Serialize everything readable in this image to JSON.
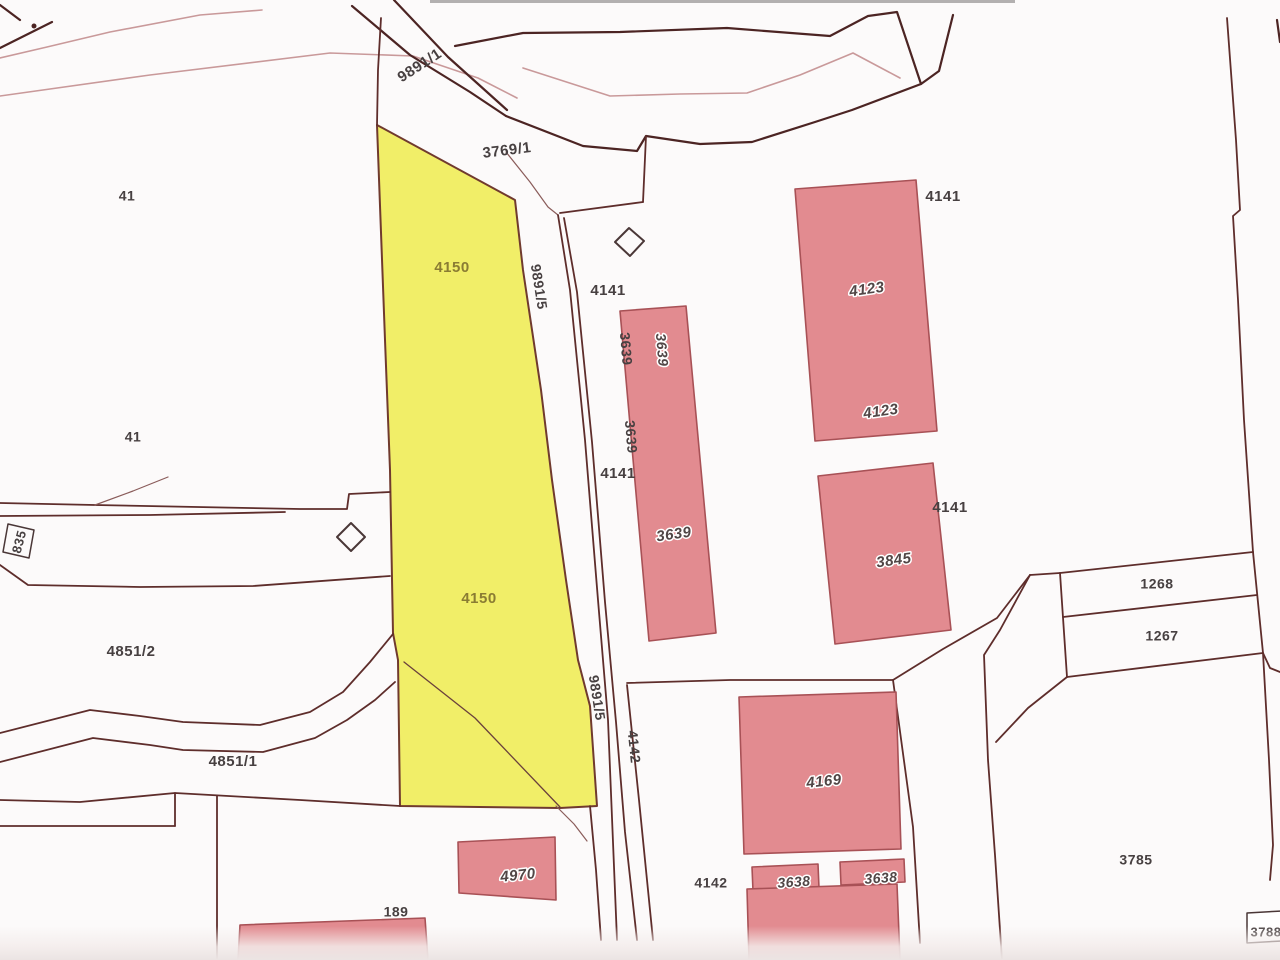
{
  "map": {
    "width": 1280,
    "height": 960,
    "background": "#fcfafa",
    "colors": {
      "highlight_parcel_fill": "#f1ee68",
      "highlight_parcel_stroke": "#703a2e",
      "building_fill": "#e28b90",
      "building_stroke": "#a85156",
      "boundary_dark": "#5e2d2b",
      "boundary_heavy": "#4c2423",
      "boundary_light": "#c9999a",
      "boundary_thin": "#8a5c5a",
      "marker_stroke": "#4a3737",
      "label_dark": "#474041",
      "label_olive": "#8a7c33"
    },
    "styles": {
      "ln": {
        "stroke": "#5e2d2b",
        "w": 1.8
      },
      "ln2": {
        "stroke": "#6a403c",
        "w": 1.3
      },
      "hv": {
        "stroke": "#4c2423",
        "w": 2.2
      },
      "lt": {
        "stroke": "#c9999a",
        "w": 1.6
      },
      "thin": {
        "stroke": "#8a5c5a",
        "w": 1.2
      },
      "mk": {
        "stroke": "#4a3737",
        "w": 2.0
      }
    },
    "polygons": [
      {
        "name": "parcel-4150-highlight",
        "fill": "#f1ee68",
        "stroke": "#703a2e",
        "w": 2,
        "pts": "377,125 515,200 523,270 541,390 552,480 566,580 578,660 590,706 597,806 560,808 400,806 398,660 393,633 390,470 385,340"
      },
      {
        "name": "building-4123",
        "fill": "#e28b90",
        "stroke": "#a85156",
        "w": 1.6,
        "pts": "795,189 916,180 937,431 815,441"
      },
      {
        "name": "building-3639",
        "fill": "#e28b90",
        "stroke": "#a85156",
        "w": 1.6,
        "pts": "620,311 686,306 716,633 649,641"
      },
      {
        "name": "building-3845",
        "fill": "#e28b90",
        "stroke": "#a85156",
        "w": 1.6,
        "pts": "818,476 933,463 951,630 835,644"
      },
      {
        "name": "building-4169",
        "fill": "#e28b90",
        "stroke": "#a85156",
        "w": 1.6,
        "pts": "739,697 896,692 901,849 744,854"
      },
      {
        "name": "building-3638-left",
        "fill": "#e28b90",
        "stroke": "#a85156",
        "w": 1.6,
        "pts": "752,867 818,864 819,888 753,891"
      },
      {
        "name": "building-3638-right",
        "fill": "#e28b90",
        "stroke": "#a85156",
        "w": 1.6,
        "pts": "840,862 904,859 905,882 841,885"
      },
      {
        "name": "building-4970",
        "fill": "#e28b90",
        "stroke": "#a85156",
        "w": 1.6,
        "pts": "458,842 555,837 556,900 459,893"
      },
      {
        "name": "building-bottom-center",
        "fill": "#e28b90",
        "stroke": "#a85156",
        "w": 1.6,
        "pts": "747,889 897,884 900,960 749,960"
      },
      {
        "name": "building-189",
        "fill": "#e28b90",
        "stroke": "#a85156",
        "w": 1.6,
        "pts": "240,925 425,918 428,960 238,960"
      },
      {
        "name": "marker-diamond-north",
        "fill": "none",
        "stroke": "#4a3737",
        "w": 2,
        "pts": "629,228 644,241 630,256 615,242"
      },
      {
        "name": "marker-diamond-west",
        "fill": "none",
        "stroke": "#4a3737",
        "w": 2,
        "pts": "351,523 365,537 351,551 337,537"
      },
      {
        "name": "label-box-835",
        "fill": "none",
        "stroke": "#4a3737",
        "w": 1.5,
        "pts": "8,524 34,530 29,558 3,552"
      },
      {
        "name": "label-box-3788",
        "fill": "#ffffff",
        "stroke": "#4a3737",
        "w": 1.5,
        "pts": "1247,913 1282,911 1282,941 1247,943"
      }
    ],
    "lines": [
      {
        "name": "fan-line-topleft-a",
        "cls": "hv",
        "pts": "0,5 20,20"
      },
      {
        "name": "fan-line-topleft-b",
        "cls": "hv",
        "pts": "0,48 52,22"
      },
      {
        "name": "fan-line-topleft-light-1",
        "cls": "lt",
        "pts": "0,58 47,47 110,32 200,15 262,10"
      },
      {
        "name": "fan-line-topleft-light-2",
        "cls": "lt",
        "pts": "0,96 150,75 330,53 413,56 478,78 517,98"
      },
      {
        "name": "road-9891-1-edge-west",
        "cls": "hv",
        "pts": "352,6 410,55 470,92 506,116"
      },
      {
        "name": "road-9891-1-edge-east",
        "cls": "hv",
        "pts": "394,0 448,57 507,110"
      },
      {
        "name": "parcel-4150-tip-line",
        "cls": "ln",
        "pts": "381,18 378,70 377,125"
      },
      {
        "name": "top-band-upper-boundary",
        "cls": "hv",
        "pts": "455,46 523,33 620,32 727,28 830,36 868,16 897,12 921,84 939,71 953,15"
      },
      {
        "name": "top-band-lower-boundary",
        "cls": "hv",
        "pts": "506,116 583,146 637,151 646,136 700,144 752,142 815,122 852,110 921,84"
      },
      {
        "name": "top-band-inner-light",
        "cls": "lt",
        "pts": "523,68 610,96 680,94 747,93 800,75 853,53 900,78"
      },
      {
        "name": "edge-mark-topright",
        "cls": "hv",
        "pts": "1277,20 1280,42"
      },
      {
        "name": "boundary-3769-drop",
        "cls": "ln",
        "pts": "646,136 643,202"
      },
      {
        "name": "boundary-3769-step",
        "cls": "ln",
        "pts": "643,202 560,213"
      },
      {
        "name": "boundary-3769-thin",
        "cls": "thin",
        "pts": "506,152 530,182 548,207 558,215"
      },
      {
        "name": "road-9891-5-east-line-1",
        "cls": "ln",
        "pts": "558,215 570,290 585,440 598,600 608,720 617,940"
      },
      {
        "name": "road-9891-5-east-line-2",
        "cls": "ln",
        "pts": "564,218 577,292 592,442 605,602 616,722 625,832 637,940"
      },
      {
        "name": "parcel-4142-west-line",
        "cls": "ln",
        "pts": "627,685 639,800 653,940"
      },
      {
        "name": "road-left-edge-extension",
        "cls": "ln",
        "pts": "590,806 596,870 601,940"
      },
      {
        "name": "road-corner-curve",
        "cls": "thin",
        "pts": "556,806 574,824 587,841"
      },
      {
        "name": "boundary-4141-4142",
        "cls": "ln",
        "pts": "627,683 730,680 893,680"
      },
      {
        "name": "boundary-3785-west",
        "cls": "ln",
        "pts": "893,680 913,827 920,943"
      },
      {
        "name": "boundary-curve-northeast",
        "cls": "ln",
        "pts": "893,680 943,649 997,618 1030,575"
      },
      {
        "name": "boundary-curve-southeast",
        "cls": "ln",
        "pts": "1030,575 1000,630 984,655 988,760 995,855 1002,960"
      },
      {
        "name": "boundary-1267-connector",
        "cls": "ln",
        "pts": "1067,677 1028,708 996,742"
      },
      {
        "name": "boundary-right-vertical",
        "cls": "ln",
        "pts": "1227,18 1236,140 1240,210 1233,216 1238,300 1244,420 1253,552"
      },
      {
        "name": "parcel-1268-top",
        "cls": "ln",
        "pts": "1060,573 1253,552"
      },
      {
        "name": "parcel-1268-left",
        "cls": "ln",
        "pts": "1060,573 1067,677"
      },
      {
        "name": "parcel-1268-1267-divider",
        "cls": "ln",
        "pts": "1063,617 1257,595"
      },
      {
        "name": "parcel-1267-bottom",
        "cls": "ln",
        "pts": "1067,677 1263,653"
      },
      {
        "name": "parcel-1268-right",
        "cls": "ln",
        "pts": "1253,552 1263,653"
      },
      {
        "name": "parcel-1268-top-connector",
        "cls": "ln",
        "pts": "1030,575 1060,573"
      },
      {
        "name": "boundary-right-edge-short",
        "cls": "ln",
        "pts": "1263,653 1270,668 1280,672"
      },
      {
        "name": "boundary-right-edge-down",
        "cls": "ln",
        "pts": "1263,653 1269,760 1273,845 1270,880"
      },
      {
        "name": "path-4851-upper",
        "cls": "ln",
        "pts": "0,733 90,710 140,716 183,722 260,725 310,712 343,692 370,662 393,634"
      },
      {
        "name": "path-4851-lower",
        "cls": "ln",
        "pts": "0,762 93,738 150,745 183,750 263,752 315,738 347,720 375,700 395,682"
      },
      {
        "name": "boundary-west-horizontal-1a",
        "cls": "ln",
        "pts": "0,503 95,505 300,509 347,509 349,494 390,492"
      },
      {
        "name": "boundary-west-horizontal-1b",
        "cls": "ln",
        "pts": "0,516 150,515 285,512"
      },
      {
        "name": "boundary-west-branch",
        "cls": "thin",
        "pts": "95,505 133,491 168,477"
      },
      {
        "name": "boundary-west-horizontal-2",
        "cls": "ln",
        "pts": "0,565 28,585 140,587 253,586 390,576"
      },
      {
        "name": "boundary-southwest-step-top",
        "cls": "ln",
        "pts": "0,800 80,802 175,793 300,800 400,806"
      },
      {
        "name": "boundary-southwest-step-vertical",
        "cls": "ln",
        "pts": "175,793 175,826"
      },
      {
        "name": "boundary-southwest-step-bottom",
        "cls": "ln",
        "pts": "0,826 175,826"
      },
      {
        "name": "boundary-189-vertical",
        "cls": "ln",
        "pts": "217,796 217,960"
      },
      {
        "name": "parcel-4150-inner-diagonal",
        "cls": "ln2",
        "pts": "404,662 475,718 560,807"
      }
    ],
    "dots": [
      {
        "name": "survey-point-topleft",
        "x": 34,
        "y": 26,
        "r": 2.5,
        "fill": "#4c2423"
      }
    ],
    "labels": [
      {
        "text": "9891/1",
        "x": 420,
        "y": 66,
        "rot": -33,
        "cls": "lbl-p",
        "size": 15,
        "name": "label-parcel-9891-1"
      },
      {
        "text": "3769/1",
        "x": 507,
        "y": 151,
        "rot": -7,
        "cls": "lbl-p",
        "size": 15,
        "name": "label-parcel-3769-1"
      },
      {
        "text": "41",
        "x": 127,
        "y": 197,
        "rot": 0,
        "cls": "lbl-p",
        "size": 14,
        "name": "label-parcel-41-north"
      },
      {
        "text": "4141",
        "x": 943,
        "y": 197,
        "rot": 0,
        "cls": "lbl-p",
        "size": 15,
        "name": "label-parcel-4141-northeast"
      },
      {
        "text": "4150",
        "x": 452,
        "y": 268,
        "rot": 0,
        "cls": "lbl-y",
        "size": 15,
        "name": "label-parcel-4150-upper"
      },
      {
        "text": "9891/5",
        "x": 538,
        "y": 287,
        "rot": 81,
        "cls": "lbl-p",
        "size": 14,
        "name": "label-road-9891-5-upper"
      },
      {
        "text": "4141",
        "x": 608,
        "y": 291,
        "rot": 0,
        "cls": "lbl-p",
        "size": 15,
        "name": "label-parcel-4141-mid-upper"
      },
      {
        "text": "3639",
        "x": 625,
        "y": 349,
        "rot": 85,
        "cls": "lbl-p",
        "size": 14,
        "name": "label-3639-edge-upper"
      },
      {
        "text": "3639",
        "x": 661,
        "y": 350,
        "rot": 85,
        "cls": "lbl-b",
        "size": 14,
        "name": "label-building-3639-upper"
      },
      {
        "text": "4123",
        "x": 867,
        "y": 290,
        "rot": -8,
        "cls": "lbl-b",
        "size": 15,
        "name": "label-building-4123-upper"
      },
      {
        "text": "4123",
        "x": 881,
        "y": 412,
        "rot": -8,
        "cls": "lbl-b",
        "size": 15,
        "name": "label-building-4123-lower"
      },
      {
        "text": "41",
        "x": 133,
        "y": 438,
        "rot": 0,
        "cls": "lbl-p",
        "size": 14,
        "name": "label-parcel-41-south"
      },
      {
        "text": "3639",
        "x": 630,
        "y": 437,
        "rot": 85,
        "cls": "lbl-p",
        "size": 14,
        "name": "label-3639-edge-lower"
      },
      {
        "text": "4141",
        "x": 618,
        "y": 474,
        "rot": 0,
        "cls": "lbl-p",
        "size": 15,
        "name": "label-parcel-4141-mid-lower"
      },
      {
        "text": "4141",
        "x": 950,
        "y": 508,
        "rot": 0,
        "cls": "lbl-p",
        "size": 15,
        "name": "label-parcel-4141-east"
      },
      {
        "text": "3639",
        "x": 674,
        "y": 535,
        "rot": -8,
        "cls": "lbl-b",
        "size": 15,
        "name": "label-building-3639-lower"
      },
      {
        "text": "835",
        "x": 20,
        "y": 542,
        "rot": -75,
        "cls": "lbl-p",
        "size": 13,
        "name": "label-parcel-835"
      },
      {
        "text": "3845",
        "x": 894,
        "y": 561,
        "rot": -8,
        "cls": "lbl-b",
        "size": 15,
        "name": "label-building-3845"
      },
      {
        "text": "1268",
        "x": 1157,
        "y": 585,
        "rot": 0,
        "cls": "lbl-p",
        "size": 14,
        "name": "label-parcel-1268"
      },
      {
        "text": "4150",
        "x": 479,
        "y": 599,
        "rot": 0,
        "cls": "lbl-y",
        "size": 15,
        "name": "label-parcel-4150-lower"
      },
      {
        "text": "1267",
        "x": 1162,
        "y": 637,
        "rot": 0,
        "cls": "lbl-p",
        "size": 14,
        "name": "label-parcel-1267"
      },
      {
        "text": "4851/2",
        "x": 131,
        "y": 652,
        "rot": 0,
        "cls": "lbl-p",
        "size": 15,
        "name": "label-parcel-4851-2"
      },
      {
        "text": "9891/5",
        "x": 596,
        "y": 698,
        "rot": 81,
        "cls": "lbl-p",
        "size": 14,
        "name": "label-road-9891-5-lower"
      },
      {
        "text": "4142",
        "x": 633,
        "y": 747,
        "rot": 84,
        "cls": "lbl-p",
        "size": 14,
        "name": "label-parcel-4142-rotated"
      },
      {
        "text": "4851/1",
        "x": 233,
        "y": 762,
        "rot": 0,
        "cls": "lbl-p",
        "size": 15,
        "name": "label-parcel-4851-1"
      },
      {
        "text": "4169",
        "x": 824,
        "y": 782,
        "rot": -6,
        "cls": "lbl-b",
        "size": 15,
        "name": "label-building-4169"
      },
      {
        "text": "3785",
        "x": 1136,
        "y": 861,
        "rot": 0,
        "cls": "lbl-p",
        "size": 14,
        "name": "label-parcel-3785"
      },
      {
        "text": "4970",
        "x": 518,
        "y": 876,
        "rot": -6,
        "cls": "lbl-b",
        "size": 15,
        "name": "label-building-4970"
      },
      {
        "text": "3638",
        "x": 794,
        "y": 883,
        "rot": -4,
        "cls": "lbl-b",
        "size": 14,
        "name": "label-building-3638-left"
      },
      {
        "text": "3638",
        "x": 881,
        "y": 879,
        "rot": -4,
        "cls": "lbl-b",
        "size": 14,
        "name": "label-building-3638-right"
      },
      {
        "text": "4142",
        "x": 711,
        "y": 884,
        "rot": 0,
        "cls": "lbl-p",
        "size": 14,
        "name": "label-parcel-4142"
      },
      {
        "text": "189",
        "x": 396,
        "y": 913,
        "rot": 0,
        "cls": "lbl-p",
        "size": 14,
        "name": "label-parcel-189"
      },
      {
        "text": "3788",
        "x": 1266,
        "y": 933,
        "rot": 0,
        "cls": "lbl-p",
        "size": 13,
        "name": "label-parcel-3788"
      }
    ]
  }
}
